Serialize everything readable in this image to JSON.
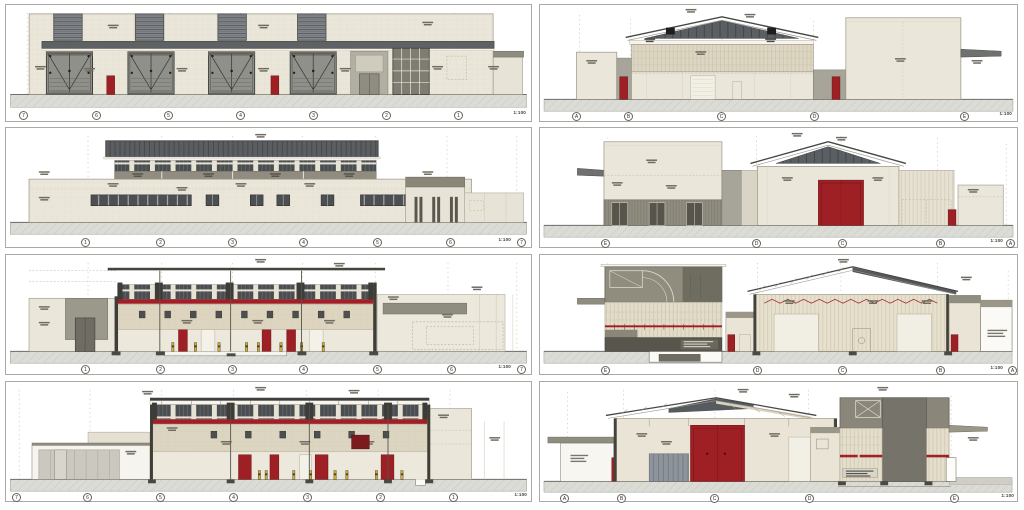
{
  "sheet": {
    "kind": "architectural elevation and section sheet",
    "panel_count": 8
  },
  "panels": [
    {
      "caption": "1:100",
      "grid_labels": [
        "7",
        "6",
        "5",
        "4",
        "3",
        "2",
        "1"
      ]
    },
    {
      "caption": "1:100",
      "grid_labels": [
        "A",
        "B",
        "C",
        "D",
        "E"
      ]
    },
    {
      "caption": "1:100",
      "grid_labels": [
        "1",
        "2",
        "3",
        "4",
        "5",
        "6",
        "7"
      ]
    },
    {
      "caption": "1:100",
      "grid_labels": [
        "E",
        "D",
        "C",
        "B",
        "A"
      ]
    },
    {
      "caption": "1:100",
      "grid_labels": [
        "1",
        "2",
        "3",
        "4",
        "5",
        "6",
        "7"
      ]
    },
    {
      "caption": "1:100",
      "grid_labels": [
        "E",
        "D",
        "C",
        "B",
        "A"
      ]
    },
    {
      "caption": "1:100",
      "grid_labels": [
        "7",
        "6",
        "5",
        "4",
        "3",
        "2",
        "1"
      ]
    },
    {
      "caption": "1:100",
      "grid_labels": [
        "A",
        "B",
        "C",
        "D",
        "E"
      ]
    }
  ],
  "colors": {
    "door_red": "#9e2025",
    "band_red": "#a12027",
    "wall_beige": "#eae6d9",
    "roof_dark": "#565b5e",
    "band_gray": "#8f8c80",
    "ground_gray": "#dcdcd7"
  }
}
